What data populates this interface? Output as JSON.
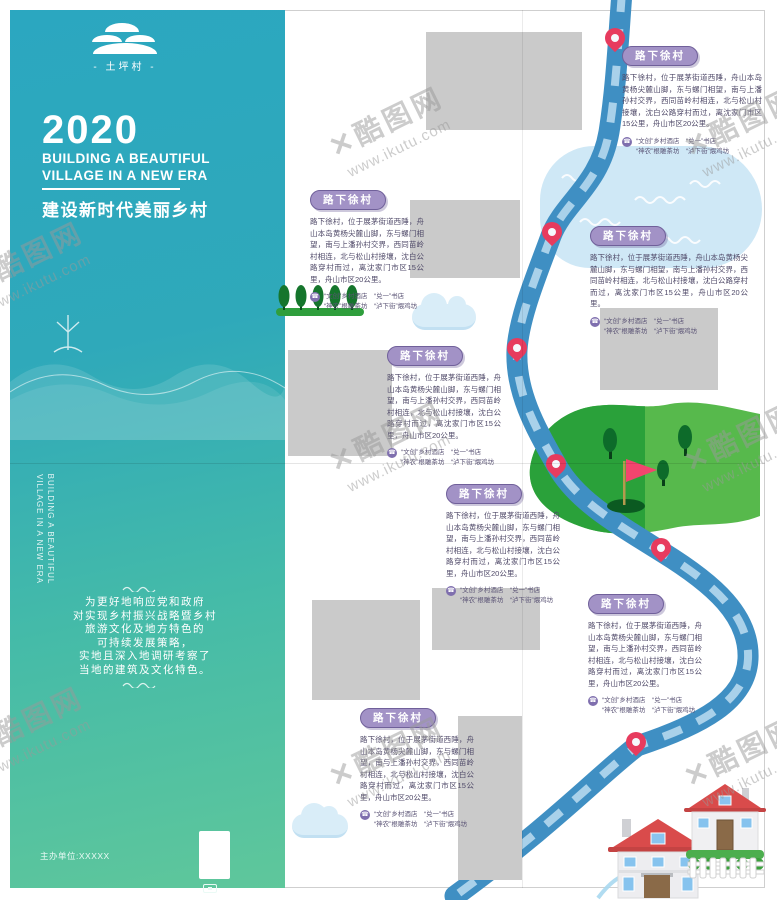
{
  "cover": {
    "logo_name": "- 土坪村 -",
    "year": "2020",
    "title_en_line1": "BUILDING A BEAUTIFUL",
    "title_en_line2": "VILLAGE IN A NEW ERA",
    "title_cn": "建设新时代美丽乡村",
    "spine_line1": "BUILDING A BEAUTIFUL",
    "spine_line2": "VILLAGE IN A NEW ERA",
    "intro_lines": [
      "为更好地响应党和政府",
      "对实现乡村振兴战略暨乡村",
      "旅游文化及地方特色的",
      "可持续发展策略，",
      "实地且深入地调研考察了",
      "当地的建筑及文化特色。"
    ],
    "organizer": "主办单位:XXXXX"
  },
  "map": {
    "blocks": [
      {
        "label": "路下徐村",
        "body": "路下徐村，位于展茅街道西陲，舟山本岛黄杨尖麓山脚，东与螺门相望，南与上潘孙村交界，西同苗岭村相连，北与松山村接壤，沈白公路穿村而过，离沈家门市区15公里，舟山市区20公里。",
        "tel_line1": "“文创”乡村酒店　“兑一”书店",
        "tel_line2": "“神农”根雕茶坊　“泸下街”煨鸡坊"
      },
      {
        "label": "路下徐村",
        "body": "路下徐村，位于展茅街道西陲，舟山本岛黄杨尖麓山脚，东与螺门相望，南与上潘孙村交界，西同苗岭村相连，北与松山村接壤，沈白公路穿村而过，离沈家门市区15公里，舟山市区20公里。",
        "tel_line1": "“文创”乡村酒店　“兑一”书店",
        "tel_line2": "“神农”根雕茶坊　“泸下街”煨鸡坊"
      },
      {
        "label": "路下徐村",
        "body": "路下徐村，位于展茅街道西陲，舟山本岛黄杨尖麓山脚，东与螺门相望，南与上潘孙村交界，西同苗岭村相连，北与松山村接壤，沈白公路穿村而过，离沈家门市区15公里，舟山市区20公里。",
        "tel_line1": "“文创”乡村酒店　“兑一”书店",
        "tel_line2": "“神农”根雕茶坊　“泸下街”煨鸡坊"
      },
      {
        "label": "路下徐村",
        "body": "路下徐村，位于展茅街道西陲，舟山本岛黄杨尖麓山脚，东与螺门相望，南与上潘孙村交界，西同苗岭村相连，北与松山村接壤，沈白公路穿村而过，离沈家门市区15公里，舟山市区20公里。",
        "tel_line1": "“文创”乡村酒店　“兑一”书店",
        "tel_line2": "“神农”根雕茶坊　“泸下街”煨鸡坊"
      },
      {
        "label": "路下徐村",
        "body": "路下徐村，位于展茅街道西陲，舟山本岛黄杨尖麓山脚，东与螺门相望，南与上潘孙村交界，西同苗岭村相连，北与松山村接壤，沈白公路穿村而过，离沈家门市区15公里，舟山市区20公里。",
        "tel_line1": "“文创”乡村酒店　“兑一”书店",
        "tel_line2": "“神农”根雕茶坊　“泸下街”煨鸡坊"
      },
      {
        "label": "路下徐村",
        "body": "路下徐村，位于展茅街道西陲，舟山本岛黄杨尖麓山脚，东与螺门相望，南与上潘孙村交界，西同苗岭村相连，北与松山村接壤，沈白公路穿村而过，离沈家门市区15公里，舟山市区20公里。",
        "tel_line1": "“文创”乡村酒店　“兑一”书店",
        "tel_line2": "“神农”根雕茶坊　“泸下街”煨鸡坊"
      },
      {
        "label": "路下徐村",
        "body": "路下徐村，位于展茅街道西陲，舟山本岛黄杨尖麓山脚，东与螺门相望，南与上潘孙村交界，西同苗岭村相连，北与松山村接壤，沈白公路穿村而过，离沈家门市区15公里，舟山市区20公里。",
        "tel_line1": "“文创”乡村酒店　“兑一”书店",
        "tel_line2": "“神农”根雕茶坊　“泸下街”煨鸡坊"
      }
    ]
  },
  "icons": {
    "tel": "☎"
  },
  "watermark": {
    "glyph": "✕",
    "brand": "酷图网",
    "url": "www.ikutu.com"
  },
  "colors": {
    "teal": "#2ba7c0",
    "green": "#5fc79b",
    "purple": "#a292c6",
    "road_blue": "#3f8fc3",
    "pin_red": "#e73b5e"
  }
}
